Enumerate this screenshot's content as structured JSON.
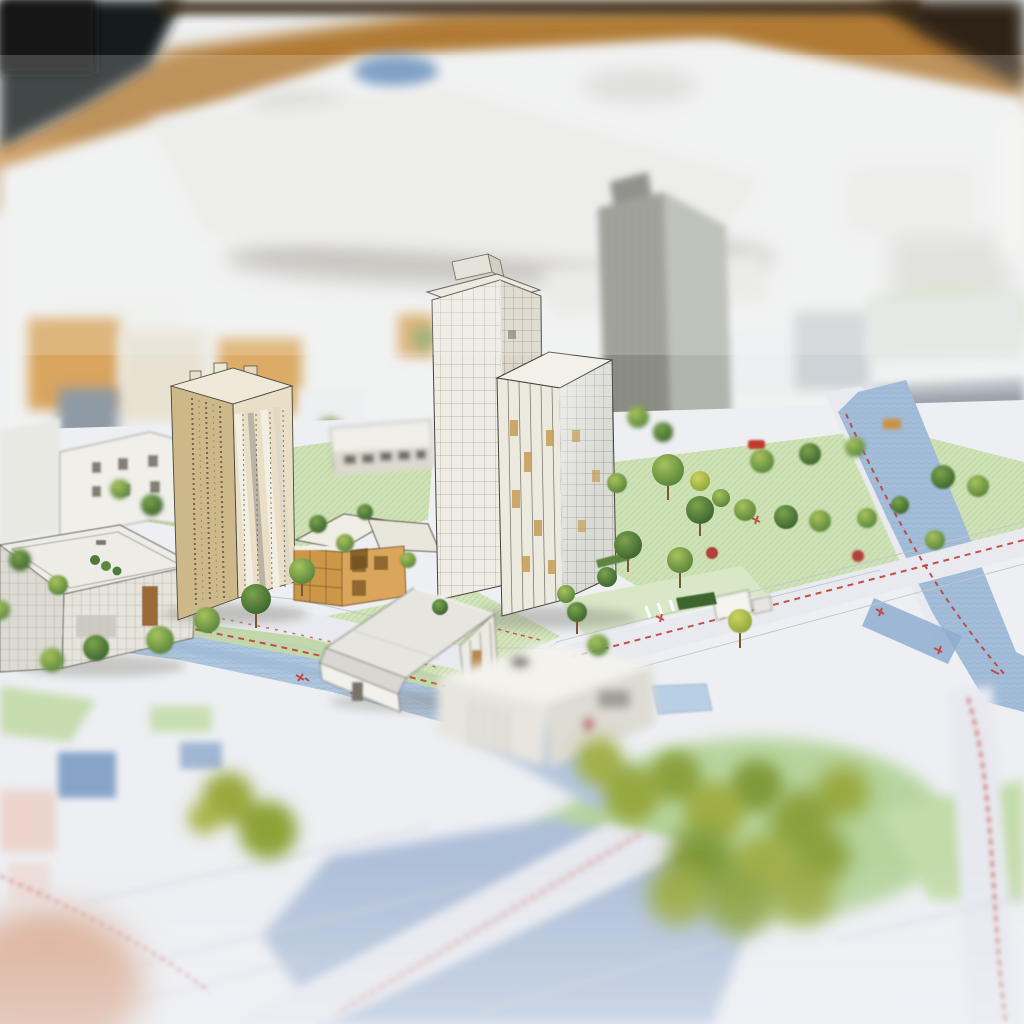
{
  "scene": {
    "type": "photograph",
    "subject": "miniature architectural scale model of a city district built on a printed site plan",
    "style": "tilt-shift macro photograph with shallow depth of field; sharp mid-band, blurred background and foreground",
    "setting": "paper model lying on a warm wooden table in front of a dark backdrop"
  },
  "palette": {
    "backdrop_dark": "#191b1d",
    "table_wood": "#b07a36",
    "model_paper": "#f1f2f2",
    "map_base": "#edeff3",
    "lawn_green": "#cfe2b6",
    "lawn_pale": "#d8e7c6",
    "water_blue": "#aec5de",
    "water_deep": "#7d9cc4",
    "road_light": "#e9eaef",
    "route_red": "#bf4038",
    "tree_light": "#b8c75e",
    "tree_dark": "#4f7a38",
    "beige_tower_wall": "#cdb88a",
    "tan_building_wall": "#cc9749",
    "white_tower_wall": "#efece3",
    "glass_tower_wall": "#d9dbd4",
    "gray_tower_wall": "#8e9087"
  },
  "objects": {
    "backdrop": "dark out-of-focus backdrop",
    "table": "wooden table edge",
    "model_bg": "out-of-focus white model blocks in background",
    "pond": "small blue pond on background model",
    "beige_tower": "beige residential tower with stepped roofline",
    "central_tower": "tall white sketch-lined office tower with rooftop plant box",
    "glass_tower": "glass curtain-wall tower with amber window panes",
    "gray_tower": "out-of-focus gray high-rise",
    "commercial_building": "low white commercial building with drawn facade grid",
    "mid_white_building": "white mid-rise block with drawn windows",
    "cut_building": "tan building model with cut-away roof",
    "school_slab": "low white slab building beside sports field",
    "gable_house": "white gabled house with glazed corner",
    "flat_house": "flat-roofed white house with garage, out of focus",
    "sheds": "small white outbuildings",
    "canal": "canal crossing the plan on the left",
    "river": "hatched river channel on the right",
    "bottom_water": "large pale water body at bottom of plan",
    "roads": "light printed roads",
    "routes": "red dashed route markings with tick clusters",
    "park": "lawns planted with model trees",
    "foreground_trees": "out-of-focus foliage in the foreground",
    "red_car": "tiny red model car",
    "orange_car": "tiny orange model vehicle",
    "flower_bush": "small red flowering bush"
  }
}
